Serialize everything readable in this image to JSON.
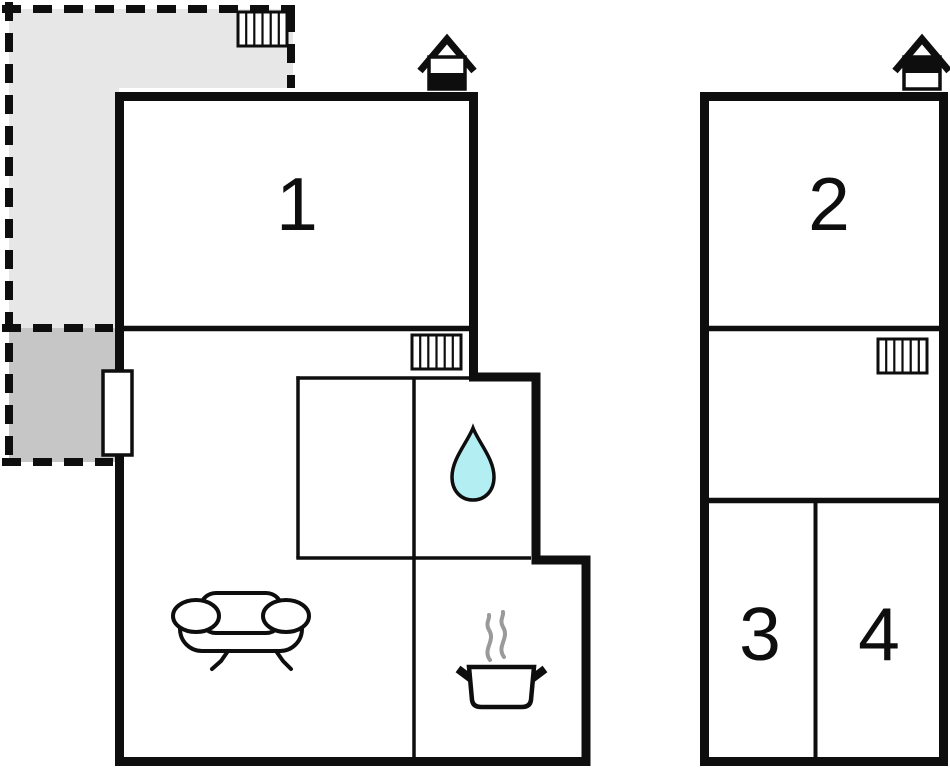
{
  "floorplan": {
    "background": "#ffffff",
    "colors": {
      "walls": "#0e0e0e",
      "terrace_light": "#e7e7e7",
      "terrace_dark": "#c6c6c6",
      "water_drop": "#b3eef2",
      "steam": "#9a9a9a",
      "label": "#0e0e0e"
    },
    "room_labels": {
      "room1": "1",
      "room2": "2",
      "room3": "3",
      "room4": "4"
    },
    "icons": {
      "entrance_left": "house-entrance-icon (white top / black bottom)",
      "entrance_right": "house-entrance-icon (black top / white bottom)",
      "radiator": "hatched-radiator-icon (6 vertical slats)",
      "sofa": "sofa-icon",
      "water_drop": "water-drop-icon",
      "cooking_pot": "steaming-pot-icon"
    }
  }
}
